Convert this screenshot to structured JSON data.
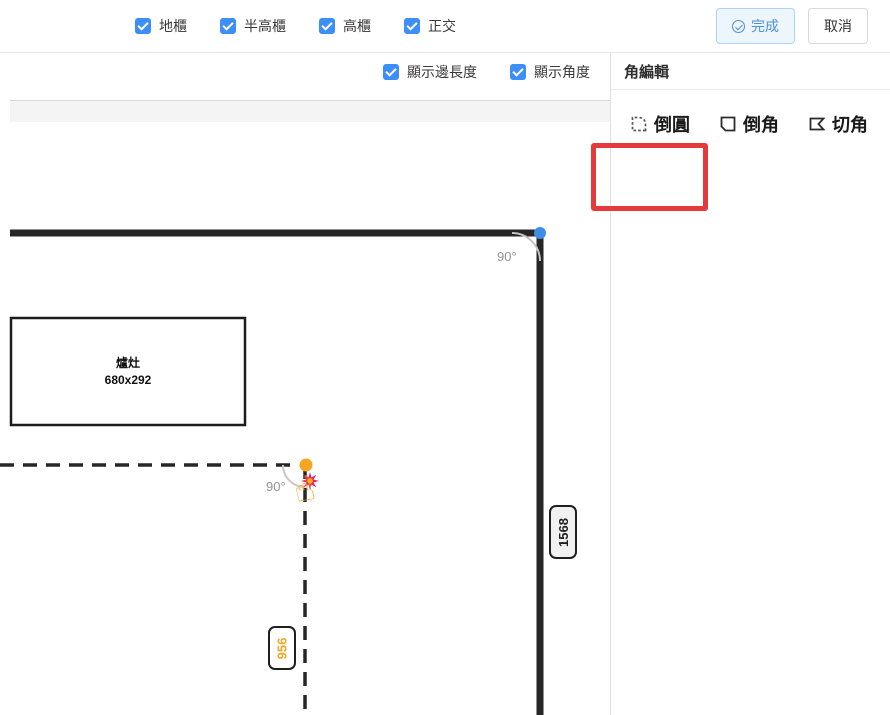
{
  "toolbar": {
    "filters": [
      {
        "label": "地櫃",
        "checked": true
      },
      {
        "label": "半高櫃",
        "checked": true
      },
      {
        "label": "高櫃",
        "checked": true
      },
      {
        "label": "正交",
        "checked": true
      }
    ],
    "done_label": "完成",
    "cancel_label": "取消"
  },
  "canvas_toggles": [
    {
      "label": "顯示邊長度",
      "checked": true
    },
    {
      "label": "顯示角度",
      "checked": true
    }
  ],
  "panel": {
    "title": "角編輯",
    "options": [
      {
        "label": "倒圓",
        "icon": "fillet-icon",
        "highlighted": true
      },
      {
        "label": "倒角",
        "icon": "chamfer-icon",
        "highlighted": false
      },
      {
        "label": "切角",
        "icon": "cut-corner-icon",
        "highlighted": false
      }
    ]
  },
  "canvas": {
    "stove": {
      "name": "爐灶",
      "size": "680x292"
    },
    "angle_top": "90°",
    "angle_mid": "90°",
    "dim_right": "1568",
    "dim_bottom": "956"
  },
  "icons": {
    "hand": "☝"
  },
  "colors": {
    "checkbox_blue": "#3e8ef7",
    "done_button_text": "#4a90e2",
    "wall": "#262626",
    "highlight_red": "#e5393c",
    "vertex_orange": "#f5a623",
    "vertex_blue": "#3e8ee8",
    "burst_pink": "#e91e63",
    "dim_orange": "#f5a623"
  }
}
